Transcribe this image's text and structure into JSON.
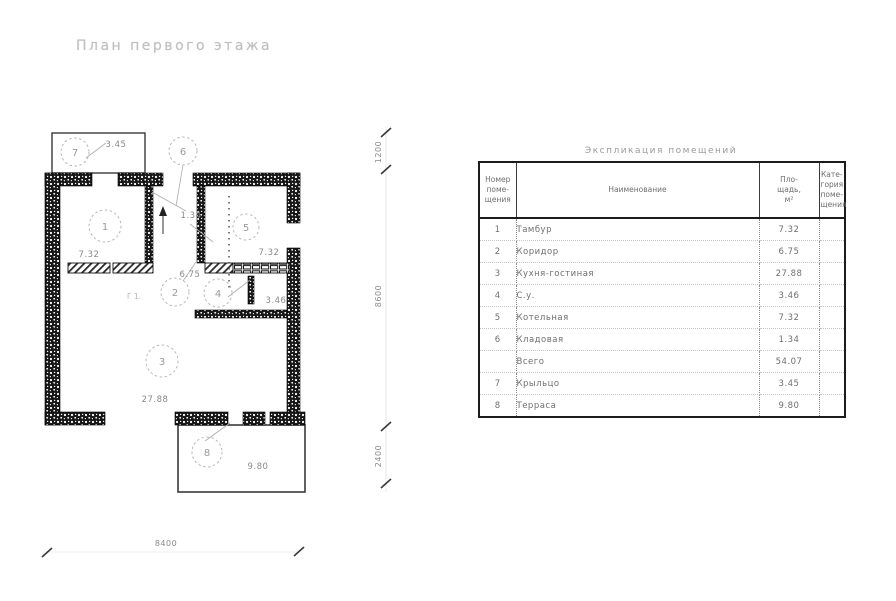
{
  "plan": {
    "title": "План первого этажа",
    "rooms": [
      {
        "num": "1",
        "area": "7.32"
      },
      {
        "num": "2",
        "area": "6.75"
      },
      {
        "num": "3",
        "area": "27.88"
      },
      {
        "num": "4",
        "area": "3.46"
      },
      {
        "num": "5",
        "area": "7.32"
      },
      {
        "num": "6",
        "area": "1.34"
      },
      {
        "num": "7",
        "area": "3.45"
      },
      {
        "num": "8",
        "area": "9.80"
      }
    ],
    "dimensions": {
      "bottom": "8400",
      "right_top": "1200",
      "right_middle": "8600",
      "right_bottom": "2400"
    },
    "misc_label": "Г 1."
  },
  "table": {
    "title": "Экспликация помещений",
    "headers": {
      "num": "Номер\nпоме-\nщения",
      "name": "Наименование",
      "area": "Пло-\nщадь,\nм²",
      "cat": "Кате-\nгория\nпоме-\nщения"
    },
    "rows": [
      {
        "num": "1",
        "name": "Тамбур",
        "area": "7.32",
        "cat": ""
      },
      {
        "num": "2",
        "name": "Коридор",
        "area": "6.75",
        "cat": ""
      },
      {
        "num": "3",
        "name": "Кухня-гостиная",
        "area": "27.88",
        "cat": ""
      },
      {
        "num": "4",
        "name": "С.у.",
        "area": "3.46",
        "cat": ""
      },
      {
        "num": "5",
        "name": "Котельная",
        "area": "7.32",
        "cat": ""
      },
      {
        "num": "6",
        "name": "Кладовая",
        "area": "1.34",
        "cat": ""
      },
      {
        "num": "",
        "name": "Всего",
        "area": "54.07",
        "cat": ""
      },
      {
        "num": "7",
        "name": "Крыльцо",
        "area": "3.45",
        "cat": ""
      },
      {
        "num": "8",
        "name": "Терраса",
        "area": "9.80",
        "cat": ""
      }
    ]
  }
}
